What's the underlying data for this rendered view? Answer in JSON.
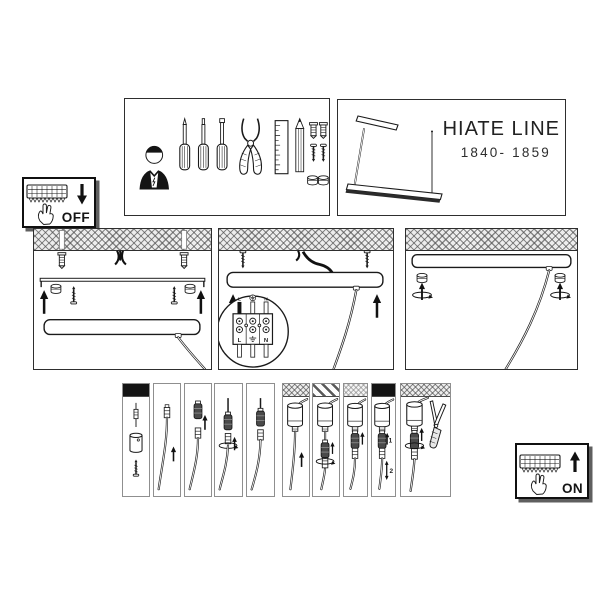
{
  "product": {
    "title": "HIATE LINE",
    "model": "1840- 1859"
  },
  "power": {
    "off": "OFF",
    "on": "ON"
  },
  "terminal_block": {
    "top": [
      "L",
      "⏚",
      "N"
    ],
    "bottom": [
      "L",
      "⏚",
      "N"
    ]
  },
  "adjust_steps": {
    "step1": "1",
    "step2": "2"
  },
  "colors": {
    "background": "#ffffff",
    "line": "#1a1a1a",
    "panel_border": "#2e2e2e",
    "step_panel_border": "#8f8f8f",
    "black_band": "#141414",
    "hatch_band": "#ededed",
    "connector_body": "#4a4a4a",
    "lamp_bar_face": "#2b2b2b"
  },
  "icons": {
    "power_off_box": [
      "terminal-strip-icon",
      "hand-icon",
      "arrow-down-icon"
    ],
    "power_on_box": [
      "terminal-strip-icon",
      "hand-icon",
      "arrow-up-icon"
    ],
    "tools_box": [
      "electrician-icon",
      "screwdriver-icon",
      "pliers-icon",
      "ruler-icon",
      "pencil-icon",
      "wall-anchor-icon",
      "screw-icon",
      "cap-nut-icon"
    ],
    "product_box": [
      "pendant-lamp-icon"
    ],
    "mounting_panels": [
      "ceiling-hatch",
      "wall-anchor-icon",
      "mains-wires-icon",
      "mounting-bracket-icon",
      "canopy-icon",
      "terminal-block-icon",
      "arrow-up-icon",
      "rotate-arrow-icon"
    ],
    "cable_steps": [
      "cable-gripper-icon",
      "cable-connector-icon",
      "wire-cutters-icon",
      "arrow-up-icon",
      "arrow-up-down-icon",
      "rotate-arrow-icon"
    ]
  }
}
